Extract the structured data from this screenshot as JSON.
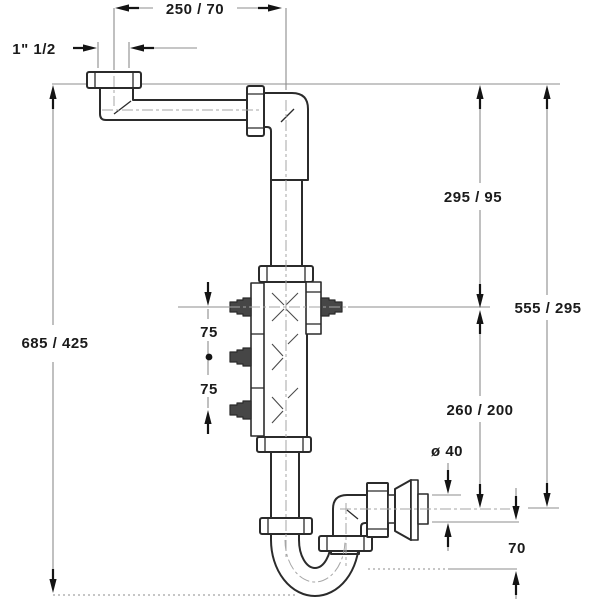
{
  "dimensions": {
    "top_offset": "250 / 70",
    "inlet_thread": "1\" 1/2",
    "overall_height": "685 / 425",
    "upper_right": "295 / 95",
    "total_right": "555 / 295",
    "lower_right": "260 / 200",
    "outlet_diameter": "ø 40",
    "trap_depth": "70",
    "branch_spacing_upper": "75",
    "branch_spacing_lower": "75"
  },
  "appearance": {
    "outline": "#2b2b2b",
    "dimension_line": "#8c8c8c",
    "centerline": "#a6a6a6",
    "arrow": "#141414",
    "text": "#1a1a1a",
    "background": "#ffffff"
  }
}
